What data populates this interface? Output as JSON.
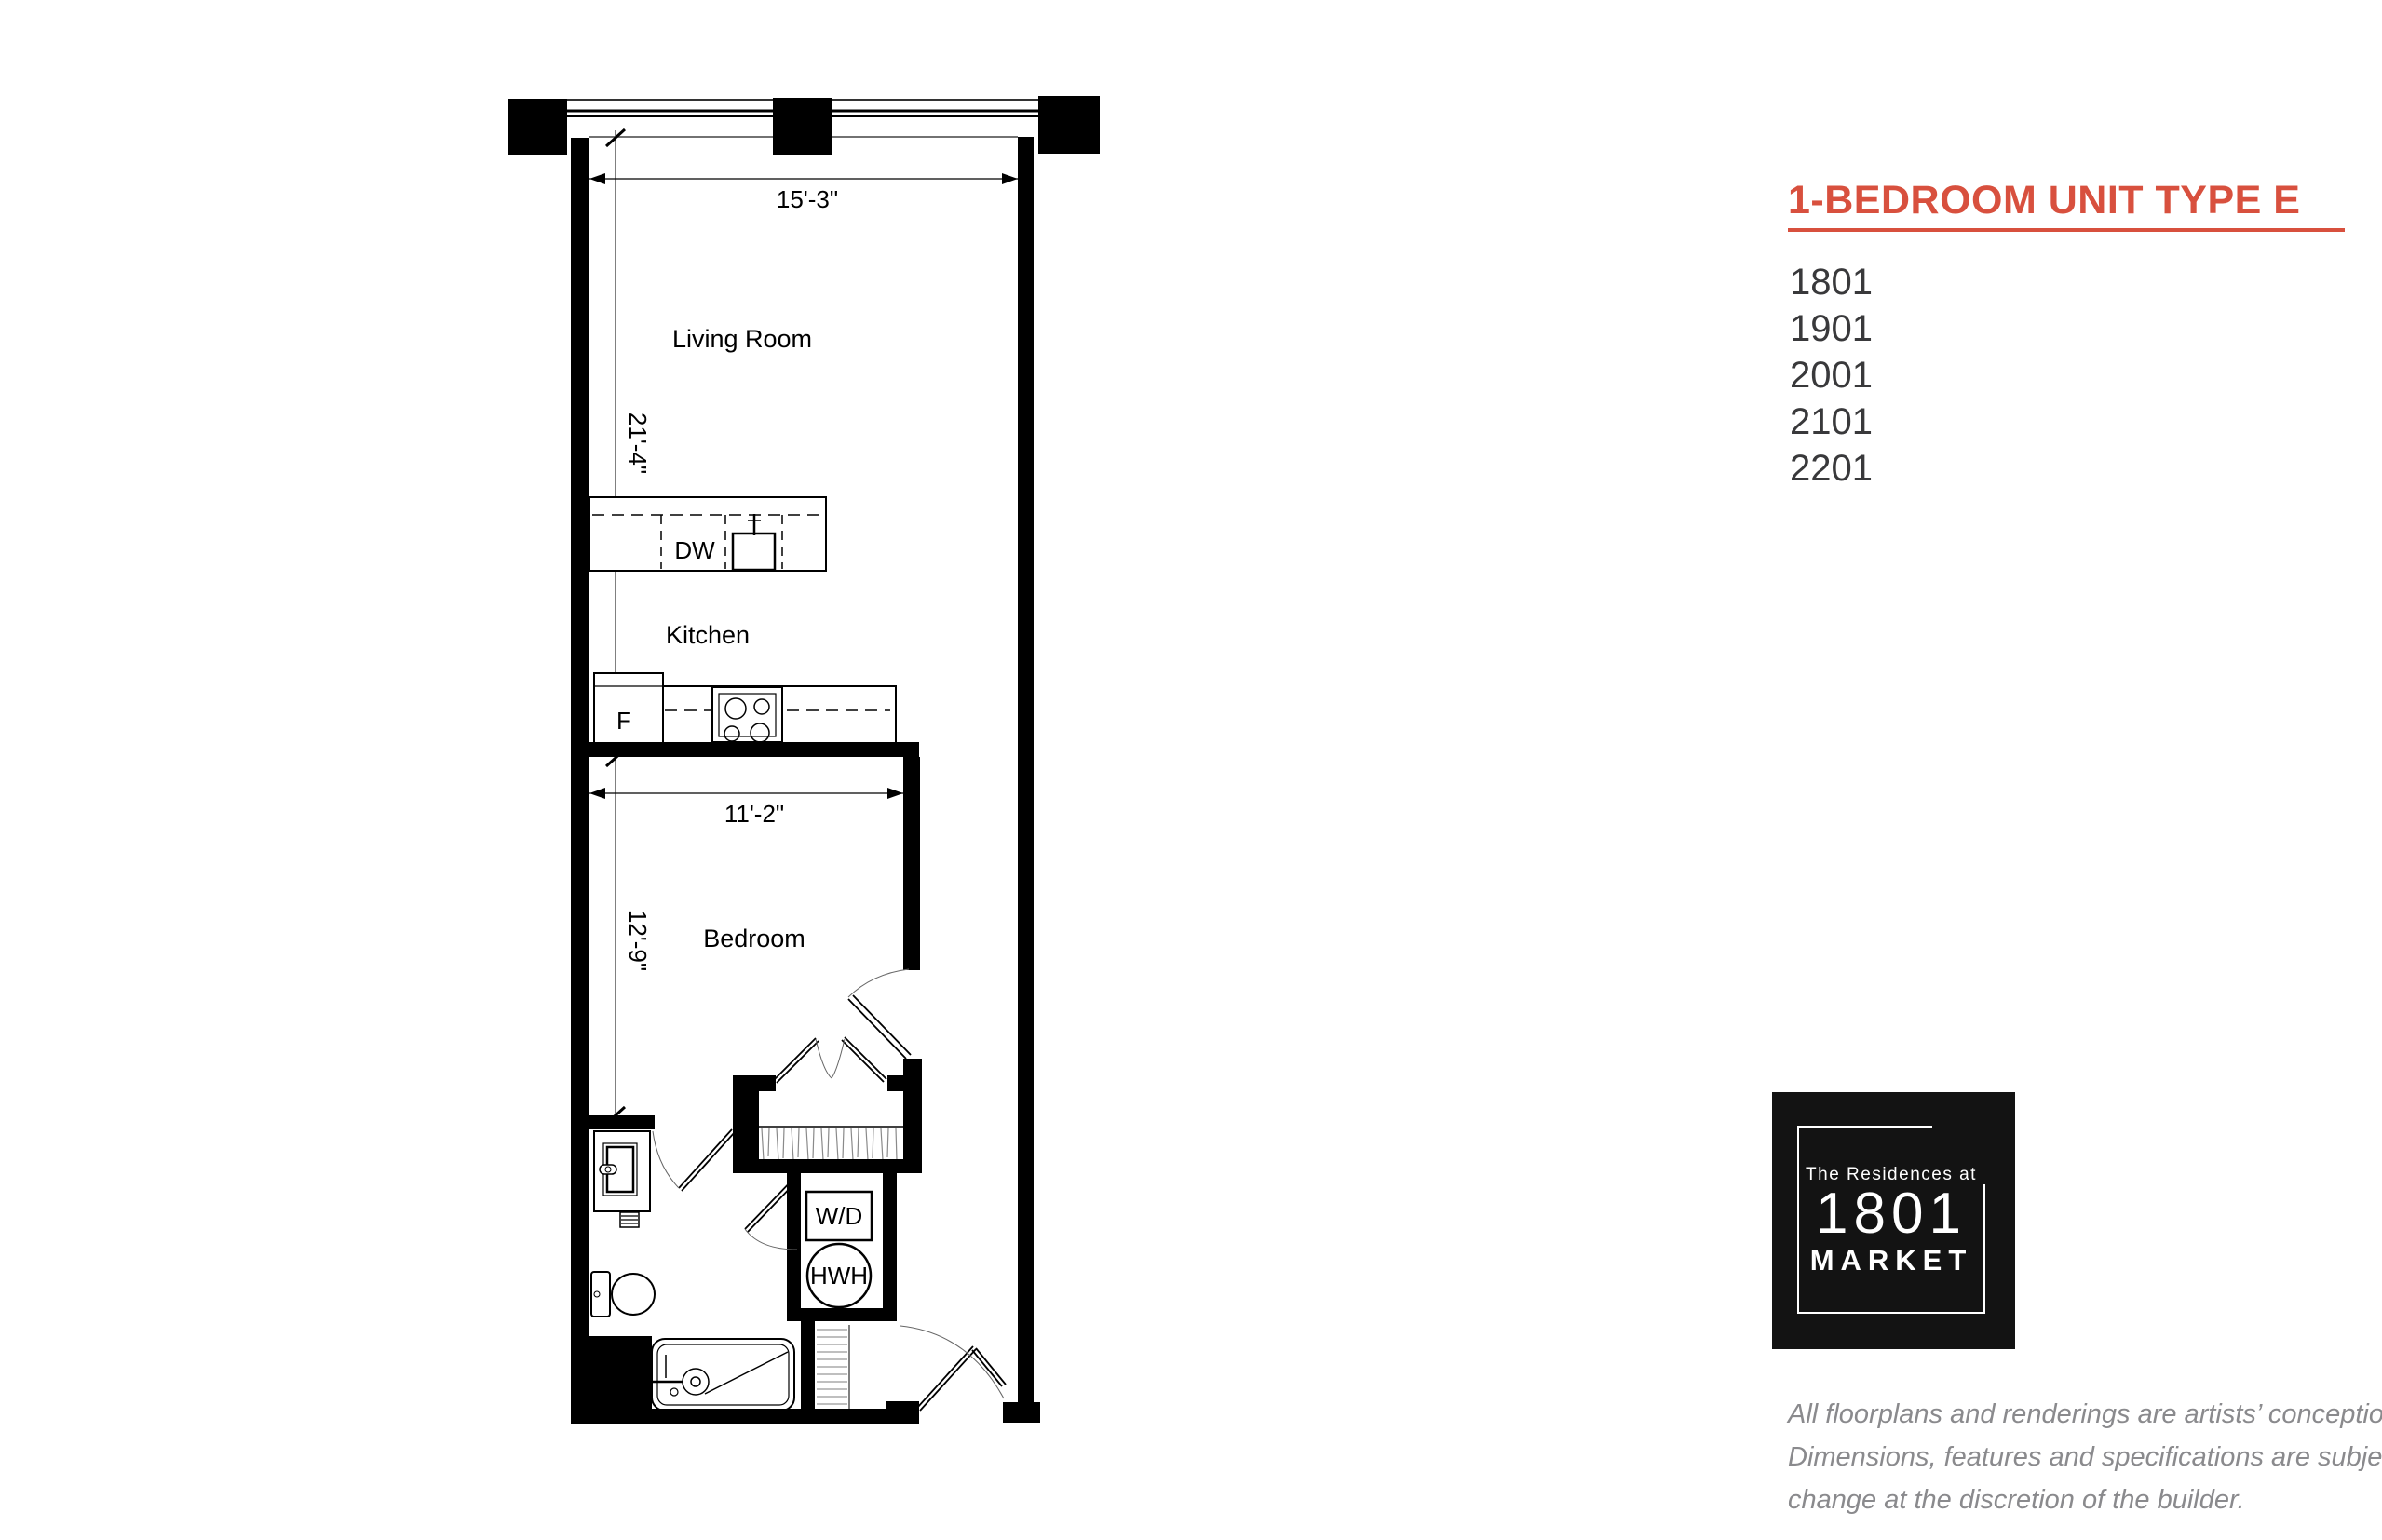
{
  "plan": {
    "labels": {
      "living_room": "Living Room",
      "kitchen": "Kitchen",
      "bedroom": "Bedroom",
      "dishwasher": "DW",
      "fridge": "F",
      "washer_dryer": "W/D",
      "water_heater": "HWH"
    },
    "dimensions": {
      "living_width": "15'-3\"",
      "living_depth": "21'-4\"",
      "bedroom_width": "11'-2\"",
      "bedroom_depth": "12'-9\""
    }
  },
  "panel": {
    "title": "1-BEDROOM UNIT TYPE E",
    "accent_color": "#d8503e",
    "units": [
      "1801",
      "1901",
      "2001",
      "2101",
      "2201"
    ],
    "logo": {
      "line1": "The Residences at",
      "line2": "1801",
      "line3": "MARKET"
    },
    "disclaimer_lines": [
      "All floorplans and renderings are artists’ conception.",
      "Dimensions, features and specifications are subject to",
      "change at the discretion of the builder."
    ]
  }
}
